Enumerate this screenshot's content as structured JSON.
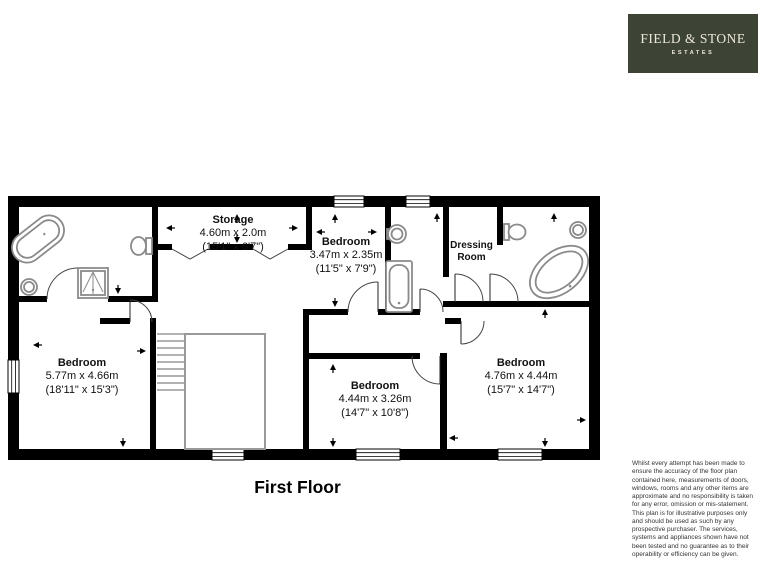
{
  "logo": {
    "brand": "FIELD & STONE",
    "sub": "ESTATES",
    "bg_color": "#3d4435",
    "text_color": "#ece8da"
  },
  "plan": {
    "title": "First Floor",
    "wall_color": "#000000",
    "fixture_color": "#8a8a8a",
    "rooms": [
      {
        "name": "Storage",
        "metric": "4.60m x 2.0m",
        "imperial": "(15'1\" x 6'7\")"
      },
      {
        "name": "Bedroom",
        "metric": "3.47m x 2.35m",
        "imperial": "(11'5\" x 7'9\")"
      },
      {
        "name": "Dressing Room"
      },
      {
        "name": "Bedroom",
        "metric": "5.77m x 4.66m",
        "imperial": "(18'11\" x 15'3\")"
      },
      {
        "name": "Bedroom",
        "metric": "4.44m x 3.26m",
        "imperial": "(14'7\" x 10'8\")"
      },
      {
        "name": "Bedroom",
        "metric": "4.76m x 4.44m",
        "imperial": "(15'7\" x 14'7\")"
      }
    ]
  },
  "disclaimer": "Whilst every attempt has been made to ensure the accuracy of the floor plan contained here, measurements of doors, windows, rooms and any other items are approximate and no responsibility is taken for any error, omission or mis-statement. This plan is for illustrative purposes only and should be used as such by any prospective purchaser. The services, systems and appliances shown have not been tested and no guarantee as to their operability or efficiency can be given."
}
